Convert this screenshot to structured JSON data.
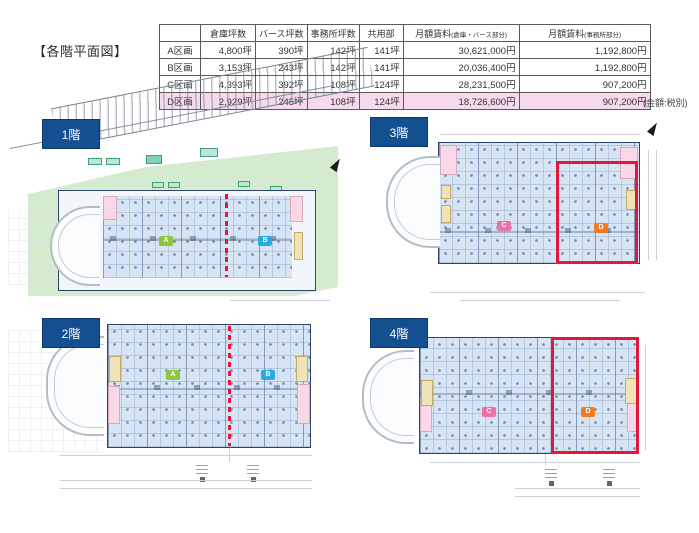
{
  "page": {
    "title": "【各階平面図】",
    "tax_note": "(金額:税別)"
  },
  "table": {
    "headers": [
      "倉庫坪数",
      "バース坪数",
      "事務所坪数",
      "共用部"
    ],
    "rent_headers": [
      {
        "main": "月額賃料",
        "sub": "(倉庫・バース部分)"
      },
      {
        "main": "月額賃料",
        "sub": "(事務所部分)"
      }
    ],
    "rows": [
      {
        "label": "A区画",
        "cells": [
          "4,800坪",
          "390坪",
          "142坪",
          "141坪",
          "30,621,000円",
          "1,192,800円"
        ],
        "highlighted": false
      },
      {
        "label": "B区画",
        "cells": [
          "3,153坪",
          "243坪",
          "142坪",
          "141坪",
          "20,036,400円",
          "1,192,800円"
        ],
        "highlighted": false
      },
      {
        "label": "C区画",
        "cells": [
          "4,393坪",
          "392坪",
          "108坪",
          "124坪",
          "28,231,500円",
          "907,200円"
        ],
        "highlighted": false
      },
      {
        "label": "D区画",
        "cells": [
          "2,929坪",
          "245坪",
          "108坪",
          "124坪",
          "18,726,600円",
          "907,200円"
        ],
        "highlighted": true
      }
    ]
  },
  "floors": [
    {
      "label": "1階",
      "sections": [
        {
          "letter": "A"
        },
        {
          "letter": "B"
        }
      ]
    },
    {
      "label": "2階",
      "sections": [
        {
          "letter": "A"
        },
        {
          "letter": "B"
        }
      ]
    },
    {
      "label": "3階",
      "sections": [
        {
          "letter": "C"
        },
        {
          "letter": "D"
        }
      ]
    },
    {
      "label": "4階",
      "sections": [
        {
          "letter": "C"
        },
        {
          "letter": "D"
        }
      ]
    }
  ],
  "colors": {
    "section_a": "#8dc63f",
    "section_b": "#29abe2",
    "section_c": "#f06eaa",
    "section_d": "#f47b20",
    "floor_badge": "#14508f",
    "highlight_row": "#f6d9ec",
    "red_outline": "#e3173c",
    "plan_fill": "#d6e4f4"
  }
}
